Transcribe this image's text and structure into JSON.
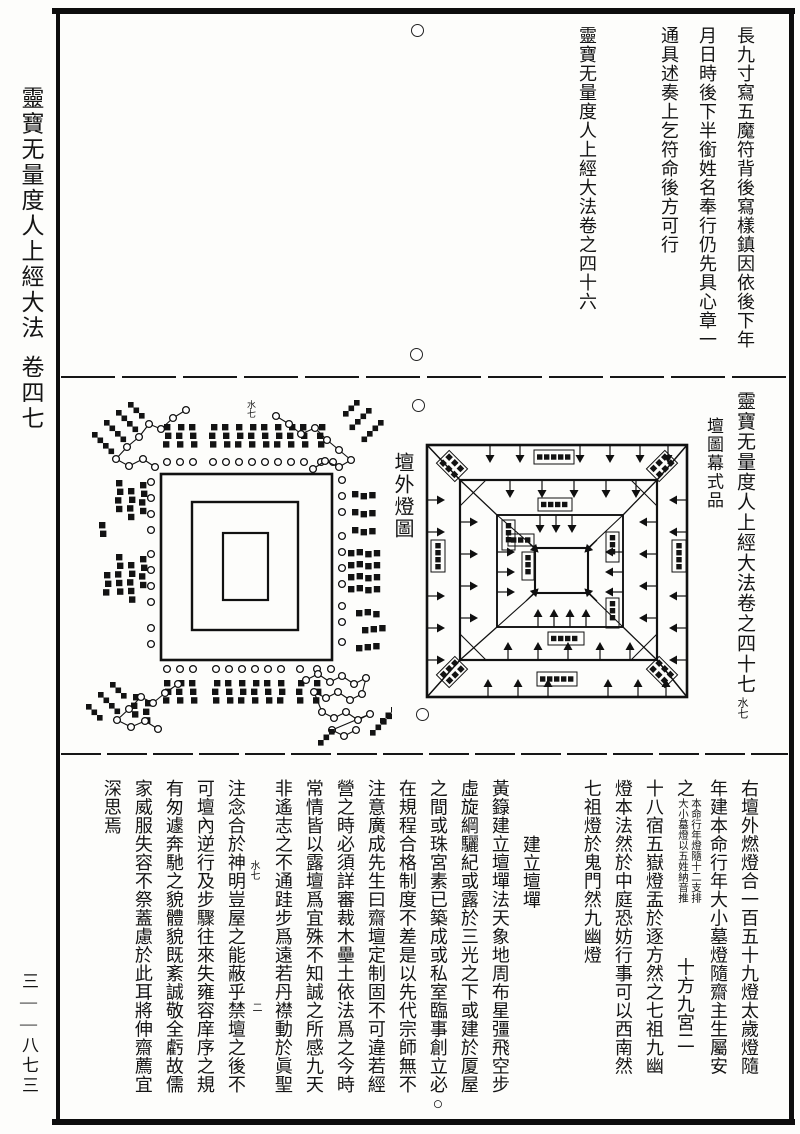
{
  "margin": {
    "title": "靈寶无量度人上經大法",
    "volume": "卷四七",
    "page_number": "三——八七三"
  },
  "top_register": {
    "columns": [
      "長九寸寫五魔符背後寫樣鎮因依後下年",
      "月日時後下半銜姓名奉行仍先具心章一",
      "通具述奏上乞符命後方可行"
    ],
    "chapter_colophon": "靈寶无量度人上經大法卷之四十六"
  },
  "middle_register": {
    "volume_title": "靈寶无量度人上經大法卷之四十七",
    "volume_fold_mark": "水七",
    "section_title": "壇圖幕式品",
    "left_diagram_title": "壇外燈圖",
    "left_fold_mark": "水七"
  },
  "bottom_register": {
    "columns_right": [
      "右壇外燃燈合一百五十九燈太歲燈隨",
      "年建本命行年大小墓燈隨齋主生屬安"
    ],
    "column_with_note": {
      "head": "之",
      "note_right": "本命行年燈隨十二支排",
      "note_left": "大小墓燈以五姓納音推",
      "tail": "十方九宮二"
    },
    "columns_after_note": [
      "十八宿五嶽燈盂於逐方然之七祖九幽",
      "燈本法然於中庭恐妨行事可以西南然",
      "七祖燈於鬼門然九幽燈"
    ],
    "heading": "建立壇墠",
    "body_columns": [
      "黃籙建立壇墠法天象地周布星彊飛空步",
      "虛旋綱驪紀或露於三光之下或建於厦屋",
      "之間或珠宮素已築成或私室臨事創立必○",
      "在規程合格制度不差是以先代宗師無不",
      "注意廣成先生曰齋壇定制固不可違若經",
      "營之時必須詳審裁木壘土依法爲之今時",
      "常情皆以露壇爲宜殊不知誠之所感九天",
      "非遙志之不通跬步爲遠若丹襟動於眞聖",
      "注念合於神明豈屋之能蔽乎禁壇之後不",
      "可壇內逆行及步驟往來失雍容庠序之規",
      "有匆遽奔馳之貌體貌既紊誠敬全虧故儒",
      "家威服失容不祭蓋慮於此耳將伸齋薦宜",
      "深思焉"
    ],
    "fold_marks": [
      "水七",
      "二"
    ]
  }
}
